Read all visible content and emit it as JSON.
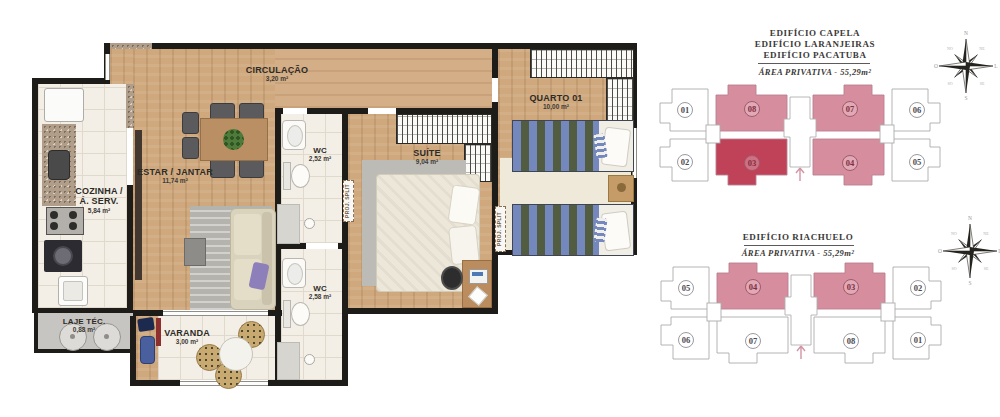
{
  "floor_plan": {
    "rooms": {
      "cozinha": {
        "name_line1": "COZINHA /",
        "name_line2": "\u00c1. SERV.",
        "area": "5,84 m\u00b2"
      },
      "estar": {
        "name": "ESTAR / JANTAR",
        "area": "11,74 m\u00b2"
      },
      "circulacao": {
        "name": "CIRCULA\u00c7\u00c3O",
        "area": "3,20 m\u00b2"
      },
      "wc_social": {
        "name": "WC",
        "area": "2,52 m\u00b2"
      },
      "wc_suite": {
        "name": "WC",
        "area": "2,58 m\u00b2"
      },
      "suite": {
        "name": "SU\u00cdTE",
        "area": "9,04 m\u00b2"
      },
      "quarto01": {
        "name": "QUARTO 01",
        "area": "10,00 m\u00b2"
      },
      "varanda": {
        "name": "VARANDA",
        "area": "3,00 m\u00b2"
      },
      "laje": {
        "name": "LAJE T\u00c9C.",
        "area": "0,88 m\u00b2"
      }
    },
    "annotations": {
      "proj_split_1": "PROJ. SPLIT",
      "proj_split_2": "PROJ. SPLIT"
    }
  },
  "key_plans": [
    {
      "titles": [
        "EDIF\u00cdCIO CAPELA",
        "EDIF\u00cdCIO LARANJEIRAS",
        "EDIF\u00cdCIO PACATUBA"
      ],
      "subtitle": "\u00c1REA PRIVATIVA - 55,29m\u00b2",
      "units": [
        {
          "number": "01",
          "highlight": "none"
        },
        {
          "number": "08",
          "highlight": "pink"
        },
        {
          "number": "07",
          "highlight": "pink"
        },
        {
          "number": "06",
          "highlight": "none"
        },
        {
          "number": "02",
          "highlight": "none"
        },
        {
          "number": "03",
          "highlight": "dark"
        },
        {
          "number": "04",
          "highlight": "pink"
        },
        {
          "number": "05",
          "highlight": "none"
        }
      ]
    },
    {
      "titles": [
        "EDIF\u00cdCIO RIACHUELO"
      ],
      "subtitle": "\u00c1REA PRIVATIVA - 55,29m\u00b2",
      "units": [
        {
          "number": "05",
          "highlight": "none"
        },
        {
          "number": "04",
          "highlight": "pink"
        },
        {
          "number": "03",
          "highlight": "pink"
        },
        {
          "number": "02",
          "highlight": "none"
        },
        {
          "number": "06",
          "highlight": "none"
        },
        {
          "number": "07",
          "highlight": "none"
        },
        {
          "number": "08",
          "highlight": "none"
        },
        {
          "number": "01",
          "highlight": "none"
        }
      ]
    }
  ],
  "compass": {
    "cardinals": [
      "N",
      "L",
      "S",
      "O"
    ],
    "intercardinals": [
      "NE",
      "SE",
      "SO",
      "NO"
    ]
  },
  "colors": {
    "unit_pink": "#d68d9d",
    "unit_dark": "#bf4259",
    "unit_number": "#822e40",
    "wall": "#1e1c19"
  }
}
